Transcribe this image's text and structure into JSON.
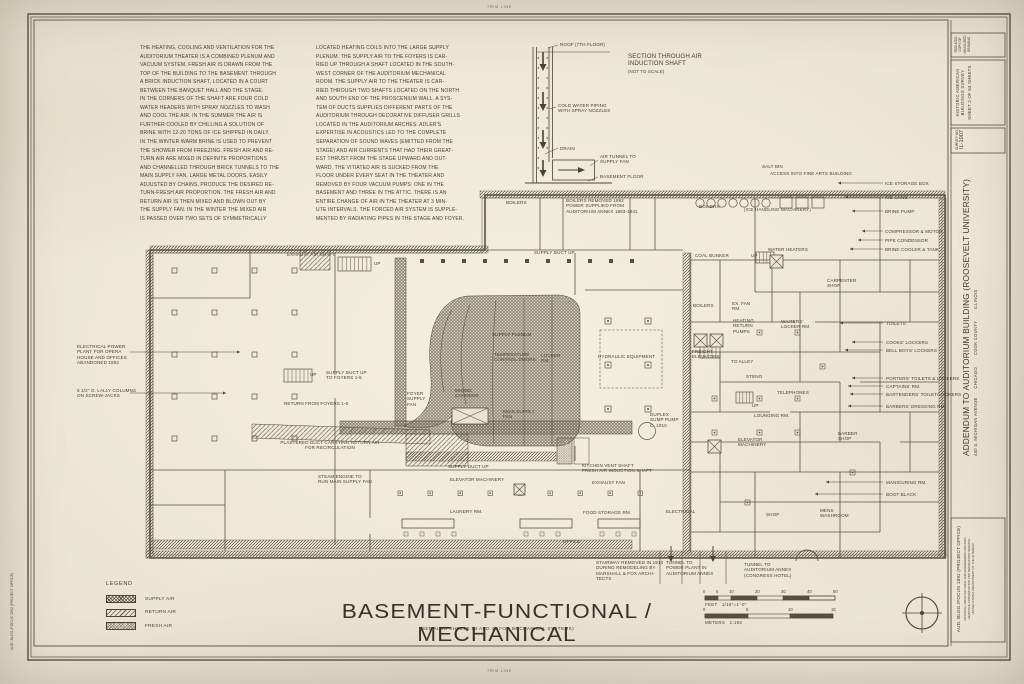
{
  "page": {
    "trim_line": "TRIM LINE"
  },
  "notes": {
    "column1": "THE HEATING, COOLING AND VENTILATION FOR THE\nAUDITORIUM THEATER IS A COMBINED PLENUM AND\nVACUUM SYSTEM.  FRESH AIR IS DRAWN FROM THE\nTOP OF THE BUILDING TO THE BASEMENT THROUGH\nA BRICK INDUCTION SHAFT, LOCATED IN A COURT\nBETWEEN THE BANQUET HALL AND THE STAGE.\nIN THE CORNERS OF THE SHAFT ARE FOUR COLD\nWATER HEADERS WITH SPRAY NOZZLES TO WASH\nAND COOL THE AIR.  IN THE SUMMER THE AIR IS\nFURTHER COOLED BY CHILLING A SOLUTION OF\nBRINE WITH 12-20 TONS OF ICE SHIPPED IN DAILY.\nIN THE WINTER WARM BRINE IS USED TO PREVENT\nTHE SHOWER FROM FREEZING.  FRESH AIR AND RE-\nTURN AIR ARE MIXED IN DEFINITE PROPORTIONS\nAND CHANNELLED THROUGH BRICK TUNNELS TO THE\nMAIN SUPPLY FAN.  LARGE METAL DOORS, EASILY\nADJUSTED BY CHAINS, PRODUCE THE DESIRED RE-\nTURN-FRESH AIR PROPORTION.  THE FRESH AIR AND\nRETURN AIR IS THEN MIXED AND BLOWN OUT BY\nTHE SUPPLY FAN.  IN THE WINTER THE MIXED AIR\nIS PASSED OVER TWO SETS OF SYMMETRICALLY",
    "column2": "LOCATED HEATING COILS INTO THE LARGE SUPPLY\nPLENUM.   THE SUPPLY AIR TO THE FOYERS IS CAR-\nRIED UP THROUGH A SHAFT LOCATED IN THE SOUTH-\nWEST CORNER OF THE AUDITORIUM MECHANICAL\nROOM.   THE SUPPLY AIR TO THE THEATER IS CAR-\nRIED THROUGH TWO SHAFTS LOCATED ON THE NORTH\nAND SOUTH END OF THE PROSCENIUM WALL.  A SYS-\nTEM OF DUCTS SUPPLIES DIFFERENT PARTS OF THE\nAUDITORIUM THROUGH DECORATIVE DIFFUSER GRILLS\nLOCATED IN THE AUDITORIUM ARCHES.   ADLER'S\nEXPERTISE IN ACOUSTICS LED TO THE COMPLETE\nSEPARATION OF SOUND WAVES (EMITTED FROM THE\nSTAGE) AND AIR CURRENTS THAT HAD THEIR GREAT-\nEST THRUST FROM THE STAGE UPWARD AND OUT-\nWARD.  THE VITIATED AIR IS SUCKED FROM THE\nFLOOR UNDER EVERY SEAT IN THE THEATER AND\nREMOVED BY FOUR VACUUM PUMPS: ONE IN THE\nBASEMENT AND THREE IN THE ATTIC.  THERE IS AN\nENTIRE CHANGE OF AIR IN THE THEATER AT 3 MIN-\nUTE INTERVALS. THE FORCED AIR SYSTEM IS SUPPLE-\nMENTED BY RADIATING PIPES IN THE STAGE AND FOYER."
  },
  "section_diagram": {
    "labels": [
      {
        "t": "SECTION THROUGH AIR\nINDUCTION SHAFT",
        "x": 628,
        "y": 53,
        "s": 6.2
      },
      {
        "t": "(NOT TO SCALE)",
        "x": 628,
        "y": 69,
        "s": 4.4
      },
      {
        "t": "ROOF (7TH FLOOR)",
        "x": 560,
        "y": 42
      },
      {
        "t": "COLD WATER PIPING\nWITH SPRAY NOZZLES",
        "x": 558,
        "y": 103
      },
      {
        "t": "DRAIN",
        "x": 560,
        "y": 146
      },
      {
        "t": "AIR TUNNEL TO\nSUPPLY FAN",
        "x": 600,
        "y": 154
      },
      {
        "t": "BASEMENT FLOOR",
        "x": 600,
        "y": 174
      }
    ]
  },
  "plan": {
    "labels": [
      {
        "t": "EXHAUST AIR SHAFT",
        "x": 287,
        "y": 252
      },
      {
        "t": "UP",
        "x": 374,
        "y": 261
      },
      {
        "t": "UP",
        "x": 310,
        "y": 372
      },
      {
        "t": "BOILERS",
        "x": 506,
        "y": 200
      },
      {
        "t": "BOILERS REMOVED 1892\nPOWER SUPPLIED FROM\nAUDITORIUM ANNEX 1893-1941",
        "x": 566,
        "y": 198
      },
      {
        "t": "BOILERS",
        "x": 699,
        "y": 204
      },
      {
        "t": "SALT BIN",
        "x": 762,
        "y": 164
      },
      {
        "t": "ACCESS INTO FINE ARTS BUILDING",
        "x": 770,
        "y": 171
      },
      {
        "t": "(ICE HANDLING MACHINERY)",
        "x": 744,
        "y": 207
      },
      {
        "t": "ICE STORAGE BOX",
        "x": 885,
        "y": 181
      },
      {
        "t": "ICE CANS",
        "x": 885,
        "y": 195
      },
      {
        "t": "BRINE PUMP",
        "x": 885,
        "y": 209
      },
      {
        "t": "COMPRESSOR & MOTOR",
        "x": 885,
        "y": 229
      },
      {
        "t": "PIPE CONDENSOR",
        "x": 885,
        "y": 238
      },
      {
        "t": "BRINE COOLER & TANK",
        "x": 885,
        "y": 247
      },
      {
        "t": "WATER HEATERS",
        "x": 768,
        "y": 247
      },
      {
        "t": "CARPENTER\nSHOP",
        "x": 827,
        "y": 278
      },
      {
        "t": "COAL BUNKER",
        "x": 695,
        "y": 253
      },
      {
        "t": "UP",
        "x": 751,
        "y": 253
      },
      {
        "t": "SUPPLY DUCT UP",
        "x": 534,
        "y": 250
      },
      {
        "t": "TOILETS",
        "x": 886,
        "y": 321
      },
      {
        "t": "COOKS' LOCKERS",
        "x": 886,
        "y": 340
      },
      {
        "t": "BELL BOYS' LOCKERS",
        "x": 886,
        "y": 348
      },
      {
        "t": "PORTERS' TOILETS & LOCKERS",
        "x": 886,
        "y": 376
      },
      {
        "t": "CAPTAINS' RM.",
        "x": 886,
        "y": 384
      },
      {
        "t": "BARTENDERS' TOILET/LOCKERS",
        "x": 886,
        "y": 392
      },
      {
        "t": "BARBERS' DRESSING RM.",
        "x": 886,
        "y": 404
      },
      {
        "t": "BARBER\nSHOP",
        "x": 838,
        "y": 431
      },
      {
        "t": "MANICURING RM.",
        "x": 886,
        "y": 480
      },
      {
        "t": "BOOT BLACK",
        "x": 886,
        "y": 492
      },
      {
        "t": "MENS\nWASHROOM",
        "x": 820,
        "y": 508
      },
      {
        "t": "SHOP",
        "x": 766,
        "y": 512
      },
      {
        "t": "ELECTRICAL",
        "x": 666,
        "y": 509
      },
      {
        "t": "FOOD STORAGE RM.",
        "x": 583,
        "y": 510
      },
      {
        "t": "LAUNDRY RM.",
        "x": 450,
        "y": 509
      },
      {
        "t": "OFFICE",
        "x": 563,
        "y": 539
      },
      {
        "t": "ELEVATOR MACHINERY",
        "x": 450,
        "y": 477
      },
      {
        "t": "SUPPLY DUCT UP",
        "x": 448,
        "y": 464
      },
      {
        "t": "KITCHEN VENT SHAFT\nFRESH AIR INDUCTION SHAFT",
        "x": 582,
        "y": 463
      },
      {
        "t": "EXHAUST FAN",
        "x": 592,
        "y": 480
      },
      {
        "t": "ELEVATOR\nMACHINERY",
        "x": 738,
        "y": 437
      },
      {
        "t": "DUPLEX\nSUMP PUMP\nC. 1910",
        "x": 650,
        "y": 412
      },
      {
        "t": "LOUNGING RM.",
        "x": 754,
        "y": 413
      },
      {
        "t": "TELEPHONES",
        "x": 777,
        "y": 390
      },
      {
        "t": "STENO",
        "x": 746,
        "y": 374
      },
      {
        "t": "UP",
        "x": 752,
        "y": 403
      },
      {
        "t": "TO ALLEY",
        "x": 731,
        "y": 359
      },
      {
        "t": "FREIGHT\nELEVATORS",
        "x": 692,
        "y": 349
      },
      {
        "t": "HEATING\nRETURN\nPUMPS",
        "x": 733,
        "y": 318
      },
      {
        "t": "EX. FAN\nRM.",
        "x": 732,
        "y": 301
      },
      {
        "t": "BOILERS",
        "x": 693,
        "y": 303
      },
      {
        "t": "WAITERS'\nLOCKER RM.",
        "x": 781,
        "y": 319
      },
      {
        "t": "HYDRAULIC EQUIPMENT",
        "x": 598,
        "y": 354
      },
      {
        "t": "LOCKER\nRM.",
        "x": 541,
        "y": 353
      },
      {
        "t": "SUPPLY PLENUM",
        "x": 492,
        "y": 332
      },
      {
        "t": "TEMPERATURE\nCONTROL DOORS",
        "x": 494,
        "y": 352
      },
      {
        "t": "MIXING\nCHAMBER",
        "x": 455,
        "y": 388
      },
      {
        "t": "MAIN SUPPLY\nFAN",
        "x": 503,
        "y": 409
      },
      {
        "t": "FOYER\nSUPPLY\nFAN",
        "x": 407,
        "y": 391
      },
      {
        "t": "SUPPLY DUCT UP\nTO FOYERS 1-6",
        "x": 326,
        "y": 370
      },
      {
        "t": "RETURN FROM FOYERS 1-6",
        "x": 284,
        "y": 401
      },
      {
        "t": "PLASTERED DUCT CARRYING RETURN AIR\nFOR RECIRCULATION",
        "x": 330,
        "y": 440,
        "a": "c"
      },
      {
        "t": "STEAM ENGINE TO\nRUN MAIN SUPPLY FAN",
        "x": 318,
        "y": 474
      },
      {
        "t": "ELECTRICAL POWER\nPLANT FOR OPERA\nHOUSE AND OFFICES\nABANDONED 1892",
        "x": 77,
        "y": 344
      },
      {
        "t": "5 1/2\" O. LALLY COLUMNS\nON SCREW-JACKS",
        "x": 77,
        "y": 388
      },
      {
        "t": "STAIRWAY REMOVED IN 1910\nDURING REMODELING BY\nMARSHALL & FOX ARCHI-\nTECTS",
        "x": 596,
        "y": 560
      },
      {
        "t": "TUNNEL TO\nPOWER PLANT IN\nAUDITORIUM ANNEX",
        "x": 666,
        "y": 560
      },
      {
        "t": "TUNNEL TO\nAUDITORIUM ANNEX\n(CONGRESS HOTEL)",
        "x": 744,
        "y": 562
      }
    ]
  },
  "legend": {
    "title": "LEGEND",
    "items": [
      {
        "label": "SUPPLY AIR",
        "pattern": "supply"
      },
      {
        "label": "RETURN AIR",
        "pattern": "return"
      },
      {
        "label": "FRESH AIR",
        "pattern": "fresh"
      }
    ]
  },
  "titles": {
    "main": "BASEMENT-FUNCTIONAL / MECHANICAL",
    "sub": "(SEE ALSO SHEETS 54 AND 47 FOR MECHANICAL SYSTEMS)"
  },
  "scale": {
    "feet_ticks": [
      {
        "t": "0",
        "x": 0
      },
      {
        "t": "5",
        "x": 13
      },
      {
        "t": "10",
        "x": 26
      },
      {
        "t": "20",
        "x": 52
      },
      {
        "t": "30",
        "x": 78
      },
      {
        "t": "40",
        "x": 104
      },
      {
        "t": "50",
        "x": 130
      }
    ],
    "feet_label": "FEET   1/16\"=1'-0\"",
    "meters_ticks": [
      {
        "t": "0",
        "x": 0
      },
      {
        "t": "5",
        "x": 43
      },
      {
        "t": "10",
        "x": 85
      },
      {
        "t": "15",
        "x": 128
      }
    ],
    "meters_label": "METERS   1:192"
  },
  "title_block": {
    "corner_note": "REDUCED COPY OF\nMEASURED DRAWING",
    "survey_header_1": "HISTORIC AMERICAN",
    "survey_header_2": "BUILDINGS SURVEY",
    "sheet_info": "SHEET 2 OF 53 SHEETS",
    "survey_no_label": "SURVEY NO.",
    "survey_no": "IL-1007",
    "project_title": "ADDENDUM TO AUDITORIUM BUILDING (ROOSEVELT UNIVERSITY)",
    "address": "430 S. MICHIGAN AVENUE      CHICAGO        COOK COUNTY        ILLINOIS",
    "credit_org": "AUD. BLDG./FOCUS 1892 (PROJECT OFFICE)",
    "credit_l1": "NATIONAL ARCHITECTURAL AND ENGINEERING RECORD",
    "credit_l2": "HERITAGE CONSERVATION AND RECREATION SERVICE",
    "credit_l3": "UNITED STATES DEPARTMENT OF THE INTERIOR"
  },
  "stamps": {
    "left_margin": "AUD. BLDG./FOCUS 1892 (PROJECT OFFICE)"
  }
}
